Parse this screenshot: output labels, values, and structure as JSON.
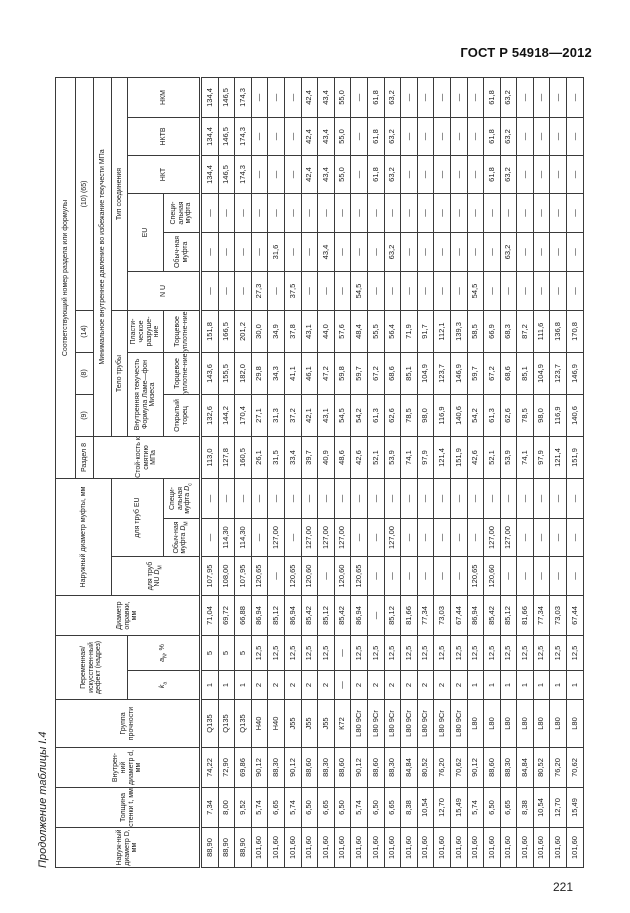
{
  "page": {
    "doc_number": "ГОСТ Р 54918—2012",
    "page_number": "221",
    "table_caption": "Продолжение таблицы I.4"
  },
  "table": {
    "header": {
      "col_d_outer": "Наруж-ный диаметр D, мм",
      "col_wall": "Толщина стенки t, мм",
      "col_d_inner": "Внутрен-ний диаметр d, мм",
      "col_grade": "Группа прочности",
      "group_variable": "Переменная/ искусствен-ный дефект (надрез)",
      "col_ka_html": "<i>k</i><sub>а</sub>",
      "col_an_html": "<i>a</i><sub>N</sub>, %",
      "col_mandrel": "Диаметр оправки, мм",
      "group_coupling_od": "Наружный диаметр муфты, мм",
      "col_nu_dm_html": "для труб NU <i>D</i><sub>М</sub>",
      "group_for_eu": "для труб EU",
      "col_eu_reg_dm_html": "Обыч-ная муфта <i>D</i><sub>М</sub>",
      "col_eu_spec_dc_html": "Специ-альная муфта <i>D</i><sub>с</sub>",
      "corresponding": "Соответствующий номер раздела или формулы",
      "section8": "Раздел 8",
      "f9": "(9)",
      "f8": "(8)",
      "f14": "(14)",
      "f10_65": "(10) (65)",
      "collapse": "Стой-кость к смятию МПа",
      "min_pressure": "Минимальное внутреннее давление во избежание текучести  МПа",
      "pipe_body": "Тело трубы",
      "conn_type": "Тип соединения",
      "int_yield_html": "Внутренняя текучесть<br>Формула Ламе—фон Мизеса",
      "plastic": "Пласти-ческое разруше-ние",
      "open_end": "Открытый торец",
      "capped_end": "Торцевое уплотне-ние",
      "nu": "N U",
      "eu": "EU",
      "eu_reg": "Обыч-ная муфта",
      "eu_spec": "Специ-альная муфта",
      "nkt": "НКТ",
      "nktv": "НКТВ",
      "nkm": "НКМ"
    },
    "rows": [
      [
        "88,90",
        "7,34",
        "74,22",
        "Q135",
        "1",
        "5",
        "71,04",
        "107,95",
        "—",
        "—",
        "113,0",
        "132,6",
        "143,6",
        "151,8",
        "—",
        "—",
        "—",
        "134,4",
        "134,4",
        "134,4"
      ],
      [
        "88,90",
        "8,00",
        "72,90",
        "Q135",
        "1",
        "5",
        "69,72",
        "108,00",
        "114,30",
        "—",
        "127,8",
        "144,2",
        "155,5",
        "166,5",
        "—",
        "—",
        "—",
        "146,5",
        "146,5",
        "146,5"
      ],
      [
        "88,90",
        "9,52",
        "69,86",
        "Q135",
        "1",
        "5",
        "66,88",
        "107,95",
        "114,30",
        "—",
        "160,5",
        "170,4",
        "182,0",
        "201,2",
        "—",
        "—",
        "—",
        "174,3",
        "174,3",
        "174,3"
      ],
      [
        "101,60",
        "5,74",
        "90,12",
        "Н40",
        "2",
        "12,5",
        "86,94",
        "120,65",
        "—",
        "—",
        "26,1",
        "27,1",
        "29,8",
        "30,0",
        "27,3",
        "—",
        "—",
        "—",
        "—",
        "—"
      ],
      [
        "101,60",
        "6,65",
        "88,30",
        "Н40",
        "2",
        "12,5",
        "85,12",
        "—",
        "127,00",
        "—",
        "31,5",
        "31,3",
        "34,3",
        "34,9",
        "—",
        "31,6",
        "—",
        "—",
        "—",
        "—"
      ],
      [
        "101,60",
        "5,74",
        "90,12",
        "J55",
        "2",
        "12,5",
        "86,94",
        "120,65",
        "—",
        "—",
        "33,4",
        "37,2",
        "41,1",
        "37,8",
        "37,5",
        "—",
        "—",
        "—",
        "—",
        "—"
      ],
      [
        "101,60",
        "6,50",
        "88,60",
        "J55",
        "2",
        "12,5",
        "85,42",
        "120,60",
        "127,00",
        "—",
        "39,7",
        "42,1",
        "46,1",
        "43,1",
        "—",
        "—",
        "—",
        "42,4",
        "42,4",
        "42,4"
      ],
      [
        "101,60",
        "6,65",
        "88,30",
        "J55",
        "2",
        "12,5",
        "85,12",
        "—",
        "127,00",
        "—",
        "40,9",
        "43,1",
        "47,2",
        "44,0",
        "—",
        "43,4",
        "—",
        "43,4",
        "43,4",
        "43,4"
      ],
      [
        "101,60",
        "6,50",
        "88,60",
        "К72",
        "—",
        "—",
        "85,42",
        "120,60",
        "127,00",
        "—",
        "48,6",
        "54,5",
        "59,8",
        "57,6",
        "—",
        "—",
        "—",
        "55,0",
        "55,0",
        "55,0"
      ],
      [
        "101,60",
        "5,74",
        "90,12",
        "L80 9Cr",
        "2",
        "12,5",
        "86,94",
        "120,65",
        "—",
        "—",
        "42,6",
        "54,2",
        "59,7",
        "48,4",
        "54,5",
        "—",
        "—",
        "—",
        "—",
        "—"
      ],
      [
        "101,60",
        "6,50",
        "88,60",
        "L80 9Cr",
        "2",
        "12,5",
        "—",
        "—",
        "—",
        "—",
        "52,1",
        "61,3",
        "67,2",
        "55,5",
        "—",
        "—",
        "—",
        "61,8",
        "61,8",
        "61,8"
      ],
      [
        "101,60",
        "6,65",
        "88,30",
        "L80 9Cr",
        "2",
        "12,5",
        "85,12",
        "—",
        "127,00",
        "—",
        "53,9",
        "62,6",
        "68,6",
        "56,4",
        "—",
        "63,2",
        "—",
        "63,2",
        "63,2",
        "63,2"
      ],
      [
        "101,60",
        "8,38",
        "84,84",
        "L80 9Cr",
        "2",
        "12,5",
        "81,66",
        "—",
        "—",
        "—",
        "74,1",
        "78,5",
        "85,1",
        "71,9",
        "—",
        "—",
        "—",
        "—",
        "—",
        "—"
      ],
      [
        "101,60",
        "10,54",
        "80,52",
        "L80 9Cr",
        "2",
        "12,5",
        "77,34",
        "—",
        "—",
        "—",
        "97,9",
        "98,0",
        "104,9",
        "91,7",
        "—",
        "—",
        "—",
        "—",
        "—",
        "—"
      ],
      [
        "101,60",
        "12,70",
        "76,20",
        "L80 9Cr",
        "2",
        "12,5",
        "73,03",
        "—",
        "—",
        "—",
        "121,4",
        "116,9",
        "123,7",
        "112,1",
        "—",
        "—",
        "—",
        "—",
        "—",
        "—"
      ],
      [
        "101,60",
        "15,49",
        "70,62",
        "L80 9Cr",
        "2",
        "12,5",
        "67,44",
        "—",
        "—",
        "—",
        "151,9",
        "140,6",
        "146,9",
        "139,3",
        "—",
        "—",
        "—",
        "—",
        "—",
        "—"
      ],
      [
        "101,60",
        "5,74",
        "90,12",
        "L80",
        "1",
        "12,5",
        "86,94",
        "120,65",
        "—",
        "—",
        "42,6",
        "54,2",
        "59,7",
        "58,5",
        "54,5",
        "—",
        "—",
        "—",
        "—",
        "—"
      ],
      [
        "101,60",
        "6,50",
        "88,60",
        "L80",
        "1",
        "12,5",
        "85,42",
        "120,60",
        "127,00",
        "—",
        "52,1",
        "61,3",
        "67,2",
        "66,9",
        "—",
        "—",
        "—",
        "61,8",
        "61,8",
        "61,8"
      ],
      [
        "101,60",
        "6,65",
        "88,30",
        "L80",
        "1",
        "12,5",
        "85,12",
        "—",
        "127,00",
        "—",
        "53,9",
        "62,6",
        "68,6",
        "68,3",
        "—",
        "63,2",
        "—",
        "63,2",
        "63,2",
        "63,2"
      ],
      [
        "101,60",
        "8,38",
        "84,84",
        "L80",
        "1",
        "12,5",
        "81,66",
        "—",
        "—",
        "—",
        "74,1",
        "78,5",
        "85,1",
        "87,2",
        "—",
        "—",
        "—",
        "—",
        "—",
        "—"
      ],
      [
        "101,60",
        "10,54",
        "80,52",
        "L80",
        "1",
        "12,5",
        "77,34",
        "—",
        "—",
        "—",
        "97,9",
        "98,0",
        "104,9",
        "111,6",
        "—",
        "—",
        "—",
        "—",
        "—",
        "—"
      ],
      [
        "101,60",
        "12,70",
        "76,20",
        "L80",
        "1",
        "12,5",
        "73,03",
        "—",
        "—",
        "—",
        "121,4",
        "116,9",
        "123,7",
        "136,8",
        "—",
        "—",
        "—",
        "—",
        "—",
        "—"
      ],
      [
        "101,60",
        "15,49",
        "70,62",
        "L80",
        "1",
        "12,5",
        "67,44",
        "—",
        "—",
        "—",
        "151,9",
        "140,6",
        "146,9",
        "170,8",
        "—",
        "—",
        "—",
        "—",
        "—",
        "—"
      ]
    ]
  }
}
